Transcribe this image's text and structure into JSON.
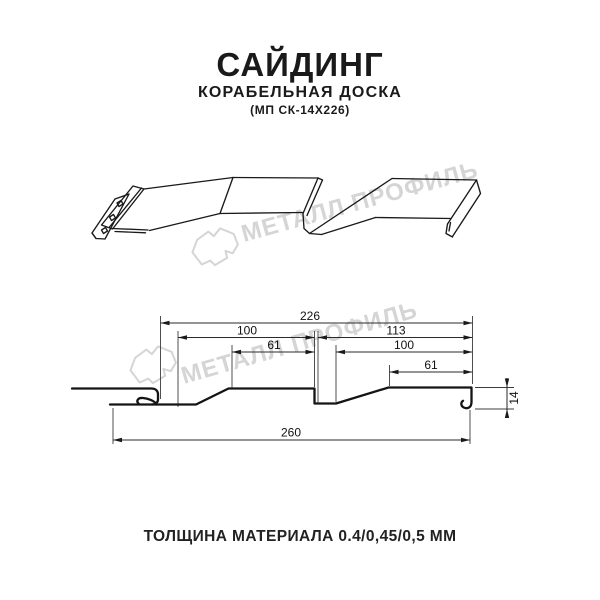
{
  "header": {
    "title": "САЙДИНГ",
    "subtitle": "КОРАБЕЛЬНАЯ ДОСКА",
    "model": "(МП СК-14Х226)"
  },
  "watermark": {
    "text": "МЕТАЛЛ ПРОФИЛЬ",
    "color": "#d5d5d5"
  },
  "section": {
    "dims": {
      "overall_top": "226",
      "left_pitch": "100",
      "right_span": "113",
      "left_face": "61",
      "right_pitch": "100",
      "right_face": "61",
      "overall_bottom": "260",
      "height": "14"
    }
  },
  "footer": {
    "thickness_label": "ТОЛЩИНА МАТЕРИАЛА 0.4/0,45/0,5 ММ"
  },
  "colors": {
    "line": "#141414",
    "thin_line": "#3c3c3c",
    "watermark": "#d5d5d5",
    "text": "#1a1a1a"
  }
}
